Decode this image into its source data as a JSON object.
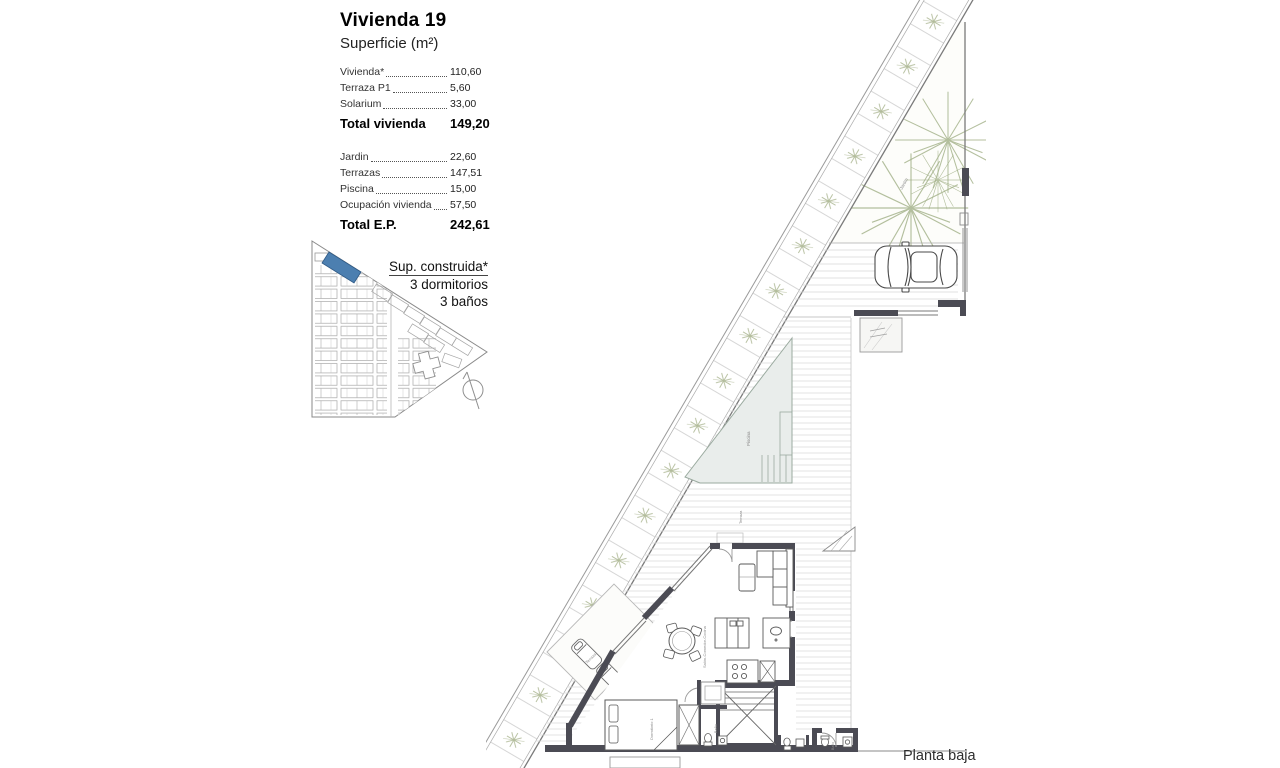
{
  "panel": {
    "title": "Vivienda 19",
    "subtitle": "Superficie (m²)",
    "section1": {
      "rows": [
        {
          "label": "Vivienda*",
          "value": "110,60"
        },
        {
          "label": "Terraza P1",
          "value": "5,60"
        },
        {
          "label": "Solarium",
          "value": "33,00"
        }
      ],
      "total": {
        "label": "Total vivienda",
        "value": "149,20"
      }
    },
    "section2": {
      "rows": [
        {
          "label": "Jardin",
          "value": "22,60"
        },
        {
          "label": "Terrazas",
          "value": "147,51"
        },
        {
          "label": "Piscina",
          "value": "15,00"
        },
        {
          "label": "Ocupación vivienda",
          "value": "57,50"
        }
      ],
      "total": {
        "label": "Total E.P.",
        "value": "242,61"
      }
    },
    "notes": {
      "line1": "Sup. construida*",
      "line2": "3 dormitorios",
      "line3": "3 baños"
    }
  },
  "plan": {
    "caption": "Planta baja",
    "labels": {
      "pool": "Piscina",
      "terrace": "Terraza",
      "garden": "Jardín",
      "bedroom": "Dormitorio 1",
      "bathroom": "Baño",
      "living": "Salón-Comedor-Cocina"
    }
  },
  "colors": {
    "unit_highlight": "#4c7fb0",
    "wall": "#4b4b54",
    "vegetation": "#9fae84",
    "pool_fill": "#e9edeb"
  }
}
